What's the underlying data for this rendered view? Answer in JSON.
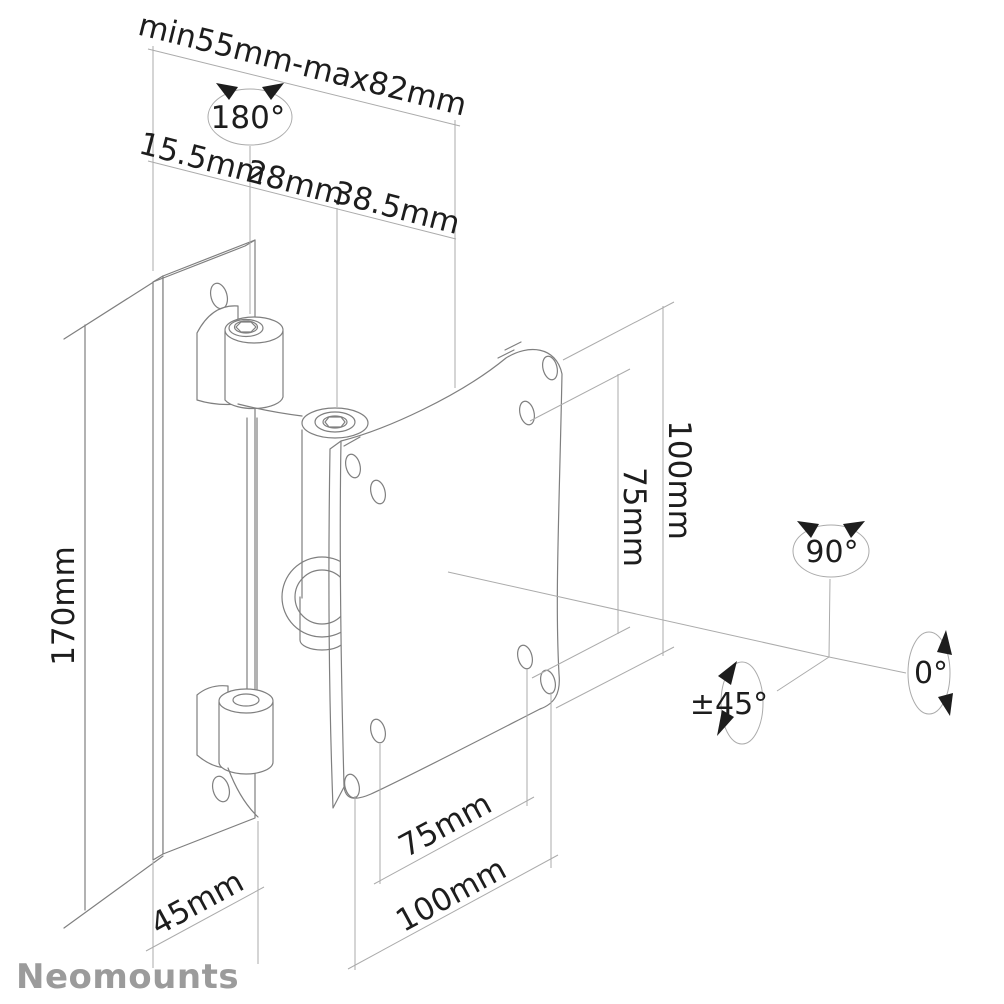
{
  "brand": "Neomounts",
  "dimensions": {
    "depth_range": "min55mm-max82mm",
    "swivel": "180°",
    "depth_segments": [
      "15.5mm",
      "28mm",
      "38.5mm"
    ],
    "bracket_height": "170mm",
    "vesa_vertical": {
      "outer": "100mm",
      "inner": "75mm"
    },
    "wallplate_width": "45mm",
    "vesa_horizontal": {
      "inner": "75mm",
      "outer": "100mm"
    },
    "rotation": {
      "top": "90°",
      "right": "0°",
      "left": "±45°"
    }
  },
  "colors": {
    "line": "#7f7f7f",
    "dimension_line": "#ababab",
    "text": "#1d1d1d",
    "brand": "#9b9b9b",
    "background": "#ffffff"
  }
}
